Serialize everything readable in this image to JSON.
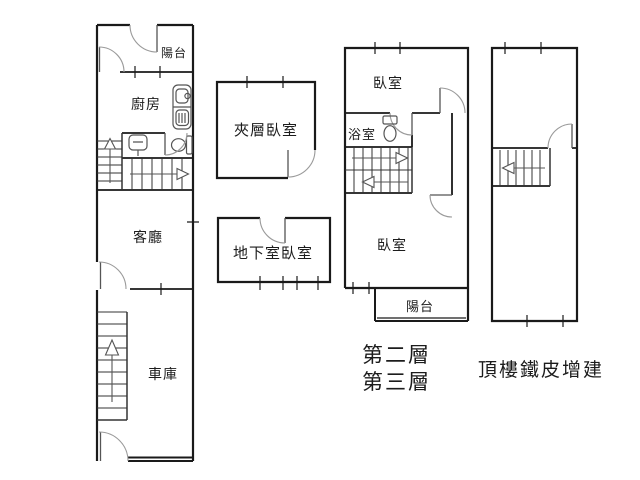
{
  "figure": {
    "kind": "residential floor plan drawing",
    "colors": {
      "background": "#ffffff",
      "wall": "#1a1a1a",
      "fixture": "#555555",
      "door_arc": "#9a9a9a",
      "text": "#1c1c1c"
    }
  },
  "labels": {
    "f1_balcony": "陽台",
    "f1_kitchen": "廚房",
    "f1_living": "客廳",
    "f1_garage": "車庫",
    "mezzanine_bedroom": "夾層臥室",
    "basement_bedroom": "地下室臥室",
    "f23_bedroom_upper": "臥室",
    "f23_bathroom": "浴室",
    "f23_bedroom_lower": "臥室",
    "f23_balcony": "陽台",
    "f23_caption_line1": "第二層",
    "f23_caption_line2": "第三層",
    "rooftop_caption": "頂樓鐵皮增建"
  },
  "icons": {
    "kitchen_sink": "kitchen-sink-stove-icon",
    "toilet": "toilet-icon",
    "washbasin": "washbasin-icon",
    "stair_up_arrow": "stair-direction-arrow-up",
    "stair_right_arrow": "stair-direction-arrow-right",
    "stair_left_arrow": "stair-direction-arrow-left",
    "window_tick": "window-tick-mark",
    "door_arc": "door-swing-arc"
  }
}
